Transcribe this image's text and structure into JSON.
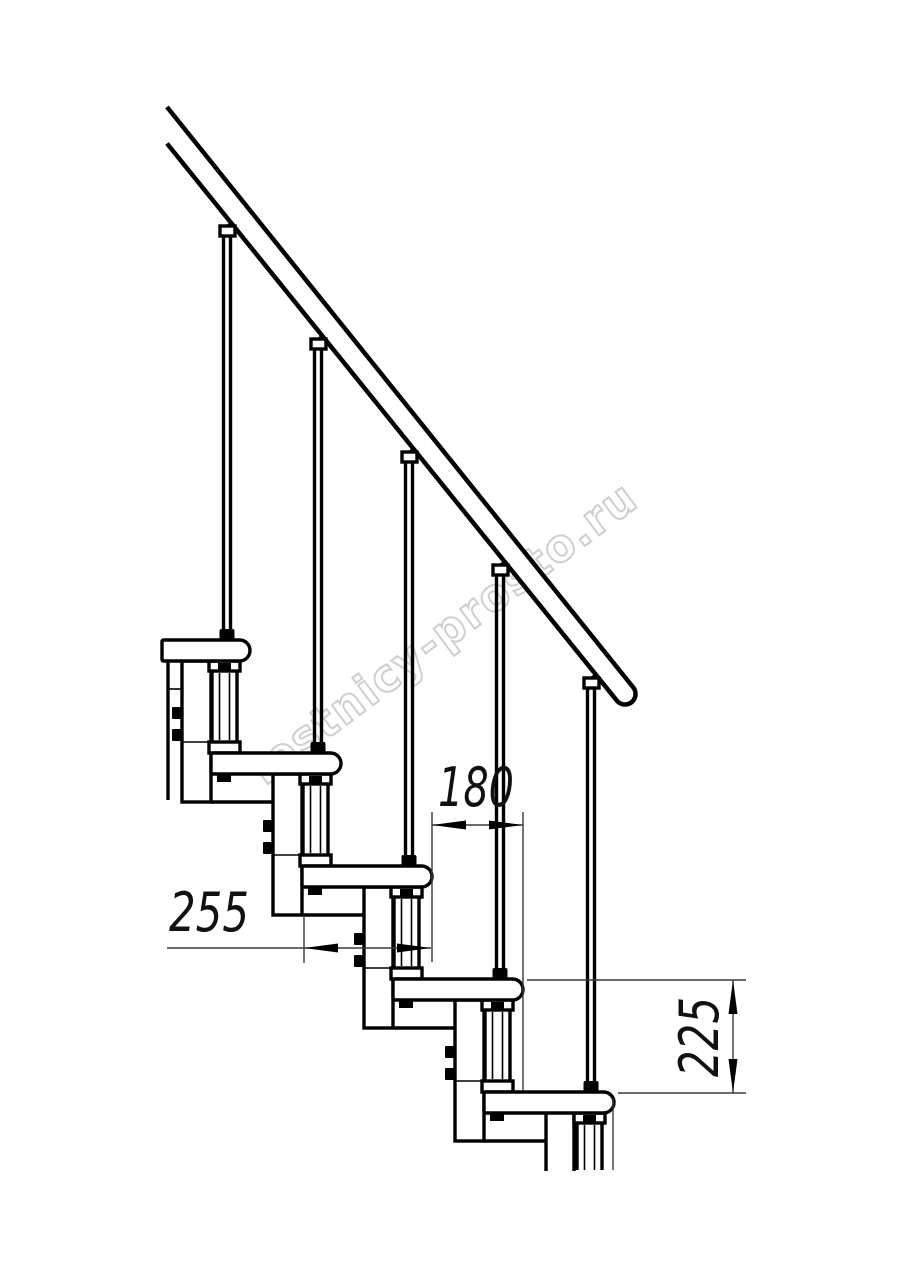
{
  "drawing": {
    "type": "modular-staircase-side-view-fragment",
    "watermark_text": "lestnicy-prosto.ru",
    "dimensions": {
      "step_run": "180",
      "tread_depth": "255",
      "step_rise": "225"
    },
    "counts": {
      "treads_visible": 5,
      "balusters_visible": 5
    },
    "colors": {
      "line": "#000000",
      "thin_line": "#3a3a3a",
      "watermark": "#c6c6c6",
      "background": "#ffffff"
    }
  }
}
